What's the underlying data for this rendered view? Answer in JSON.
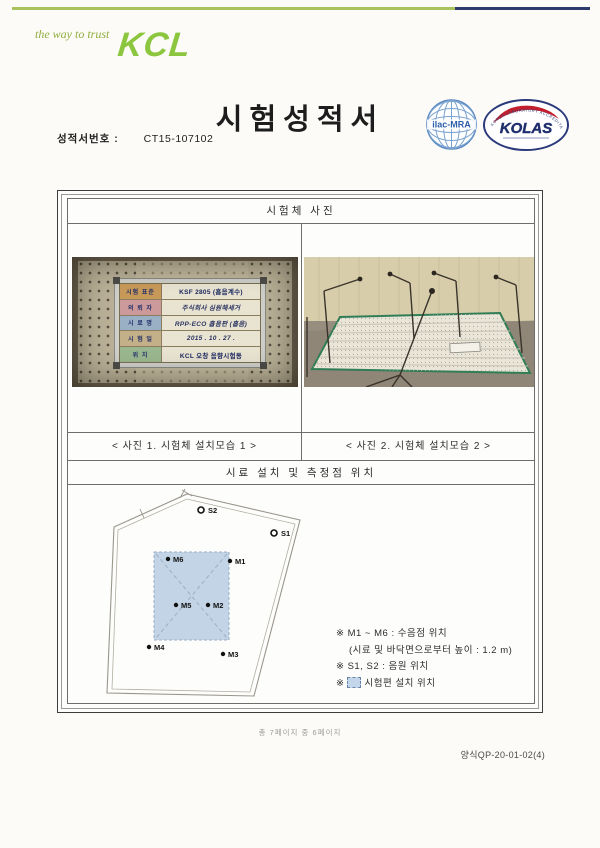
{
  "brand": {
    "tagline": "the way to trust",
    "name": "KCL",
    "green": "#8cc63f",
    "navy": "#2e3a6e"
  },
  "header": {
    "title": "시험성적서",
    "report_no_label": "성적서번호 :",
    "report_no_value": "CT15-107102"
  },
  "logos": {
    "ilac": {
      "label": "ilac-MRA"
    },
    "kolas": {
      "label": "KOLAS",
      "ring_text": "KOREA LABORATORY ACCREDITATION SCHEME"
    }
  },
  "sections": {
    "photos_title": "시험체 사진",
    "diagram_title": "시료 설치 및 측정점 위치"
  },
  "photo1": {
    "caption": "< 사진 1. 시험체 설치모습 1 >",
    "sign_rows": [
      {
        "label": "시험 표준",
        "value": "KSF 2805 (흡음계수)",
        "label_bg": "#c89a5a"
      },
      {
        "label": "의 뢰 자",
        "value": "주식회사 심원해세거",
        "label_bg": "#cc9a9a"
      },
      {
        "label": "시 료 명",
        "value": "RPP-ECO 흡음판 (흡음)",
        "label_bg": "#9ab0c4"
      },
      {
        "label": "시 험 일",
        "value": "2015 . 10 . 27 .",
        "label_bg": "#c4b088"
      },
      {
        "label": "위  치",
        "value": "KCL 오창 음향시험동",
        "label_bg": "#9ab890"
      }
    ]
  },
  "photo2": {
    "caption": "< 사진 2. 시험체 설치모습 2 >"
  },
  "diagram": {
    "points": {
      "m1": "M1",
      "m2": "M2",
      "m3": "M3",
      "m4": "M4",
      "m5": "M5",
      "m6": "M6",
      "s1": "S1",
      "s2": "S2"
    },
    "panel_fill": "#c3d6ea",
    "legend": {
      "line1": "※ M1 ~ M6 : 수음점 위치",
      "line2": "(시료 및 바닥면으로부터 높이 : 1.2 m)",
      "line3": "※ S1, S2 : 음원 위치",
      "line4_prefix": "※",
      "line4_text": "시험편 설치 위치"
    }
  },
  "footer": {
    "page_info": "총 7페이지 중 6페이지",
    "form_no": "양식QP-20-01-02(4)"
  }
}
